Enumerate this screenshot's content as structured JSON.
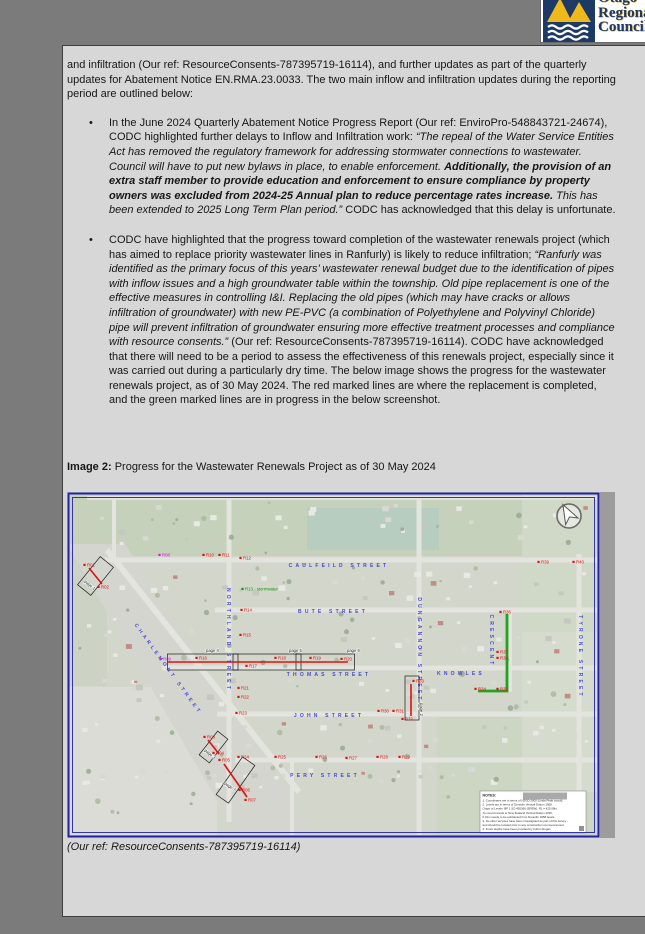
{
  "logo": {
    "line1": "Otago",
    "line2": "Regional",
    "line3": "Council",
    "navy": "#1d3a66",
    "gold": "#efb91c"
  },
  "doc": {
    "bullet_char": "•",
    "para1": [
      {
        "t": "and infiltration (Our ref: ResourceConsents-787395719-16114), and further updates as part of the quarterly updates for Abatement Notice EN.RMA.23.0033. The two main inflow and infiltration updates during the reporting period are outlined below:",
        "s": ""
      }
    ],
    "bullet1": [
      {
        "t": "In the June 2024 Quarterly Abatement Notice Progress Report (Our ref: EnviroPro-548843721-24674), CODC highlighted further delays to Inflow and Infiltration work: ",
        "s": ""
      },
      {
        "t": "“The repeal of the Water Service Entities Act has removed the regulatory framework for addressing stormwater connections to wastewater. Council will have to put new bylaws in place, to enable enforcement. ",
        "s": "i"
      },
      {
        "t": "Additionally, the provision of an extra staff member to provide education and enforcement to ensure compliance by property owners was excluded from 2024-25 Annual plan to reduce percentage rates increase.",
        "s": "bi"
      },
      {
        "t": " This has been extended to 2025 Long Term Plan period.”",
        "s": "i"
      },
      {
        "t": " CODC has acknowledged that this delay is unfortunate.",
        "s": ""
      }
    ],
    "bullet2": [
      {
        "t": "CODC have highlighted that the progress toward completion of the wastewater renewals project (which has aimed to replace priority wastewater lines in Ranfurly) is likely to reduce infiltration; ",
        "s": ""
      },
      {
        "t": "“Ranfurly was identified as the primary focus of this years’ wastewater renewal budget due to the identification of pipes with inflow issues and a high groundwater table within the township. Old pipe replacement is one of the effective measures in controlling I&I. Replacing the old pipes (which may have cracks or allows infiltration of groundwater) with new PE-PVC (a combination of Polyethylene and Polyvinyl Chloride) pipe will prevent infiltration of groundwater ensuring more effective treatment processes and compliance with resource consents.”",
        "s": "i"
      },
      {
        "t": " (Our ref: ResourceConsents-787395719-16114). CODC have acknowledged that there will need to be a period to assess the effectiveness of this renewals project, especially since it was carried out during a particularly dry time. The below image shows the progress for the wastewater renewals project, as of 30 May 2024. The red marked lines are where the replacement is completed, and the green marked lines are in progress in the below screenshot.",
        "s": ""
      }
    ],
    "caption": [
      {
        "t": "Image 2:",
        "s": "b"
      },
      {
        "t": " Progress for the Wastewater Renewals Project as of 30 May 2024",
        "s": ""
      }
    ],
    "footer_ref": [
      {
        "t": "(Our ref: ResourceConsents-787395719-16114)",
        "s": "i"
      }
    ]
  },
  "map": {
    "colors": {
      "red": "#e01010",
      "magenta": "#d818d8",
      "green_line": "#1fa41f",
      "green_text": "#0a9a0a",
      "street_blue": "#3b3bd2",
      "border_blue": "#2323a8"
    },
    "streets": [
      {
        "label": "CAULFEILD STREET",
        "x": 272,
        "y": 75,
        "rot": 0
      },
      {
        "label": "BUTE STREET",
        "x": 266,
        "y": 121,
        "rot": 0
      },
      {
        "label": "THOMAS STREET",
        "x": 262,
        "y": 184,
        "rot": 0
      },
      {
        "label": "JOHN STREET",
        "x": 262,
        "y": 225,
        "rot": 0
      },
      {
        "label": "PERY STREET",
        "x": 258,
        "y": 285,
        "rot": 0
      },
      {
        "label": "KNOWLES",
        "x": 394,
        "y": 183,
        "rot": 0
      },
      {
        "label": "NORTHLAND STREET",
        "x": 160,
        "y": 148,
        "rot": 90
      },
      {
        "label": "DUNGANNON STREET",
        "x": 351,
        "y": 158,
        "rot": 90
      },
      {
        "label": "TYRONE STREET",
        "x": 512,
        "y": 165,
        "rot": 90
      },
      {
        "label": "CRESCENT",
        "x": 423,
        "y": 149,
        "rot": 90
      },
      {
        "label": "CHARLEMONT STREET",
        "x": 100,
        "y": 178,
        "rot": 54
      }
    ],
    "markers": [
      {
        "label": "R01",
        "x": 20,
        "y": 73,
        "c": "r"
      },
      {
        "label": "R02",
        "x": 34,
        "y": 95,
        "c": "r"
      },
      {
        "label": "R03",
        "x": 140,
        "y": 245,
        "c": "r"
      },
      {
        "label": "R04",
        "x": 149,
        "y": 261,
        "c": "r"
      },
      {
        "label": "R05",
        "x": 155,
        "y": 268,
        "c": "r"
      },
      {
        "label": "R06",
        "x": 175,
        "y": 298,
        "c": "r"
      },
      {
        "label": "R07",
        "x": 181,
        "y": 308,
        "c": "r"
      },
      {
        "label": "R08",
        "x": 95,
        "y": 63,
        "c": "m"
      },
      {
        "label": "R09",
        "x": 96,
        "y": 167,
        "c": "m"
      },
      {
        "label": "R10",
        "x": 139,
        "y": 63,
        "c": "r"
      },
      {
        "label": "R11",
        "x": 155,
        "y": 63,
        "c": "r"
      },
      {
        "label": "R12",
        "x": 176,
        "y": 66,
        "c": "r"
      },
      {
        "label": "R13 - stormwater",
        "x": 178,
        "y": 97,
        "c": "g"
      },
      {
        "label": "R14",
        "x": 177,
        "y": 118,
        "c": "r"
      },
      {
        "label": "R15",
        "x": 176,
        "y": 143,
        "c": "r"
      },
      {
        "label": "R16",
        "x": 132,
        "y": 166,
        "c": "r"
      },
      {
        "label": "R17",
        "x": 182,
        "y": 174,
        "c": "r"
      },
      {
        "label": "R18",
        "x": 211,
        "y": 166,
        "c": "r"
      },
      {
        "label": "R19",
        "x": 246,
        "y": 166,
        "c": "r"
      },
      {
        "label": "R20",
        "x": 277,
        "y": 167,
        "c": "r"
      },
      {
        "label": "R21",
        "x": 174,
        "y": 196,
        "c": "r"
      },
      {
        "label": "R22",
        "x": 174,
        "y": 205,
        "c": "r"
      },
      {
        "label": "R23",
        "x": 172,
        "y": 221,
        "c": "r"
      },
      {
        "label": "R24",
        "x": 174,
        "y": 265,
        "c": "r"
      },
      {
        "label": "R25",
        "x": 211,
        "y": 265,
        "c": "r"
      },
      {
        "label": "R26",
        "x": 252,
        "y": 265,
        "c": "r"
      },
      {
        "label": "R27",
        "x": 282,
        "y": 266,
        "c": "r"
      },
      {
        "label": "R28",
        "x": 313,
        "y": 265,
        "c": "r"
      },
      {
        "label": "R29",
        "x": 335,
        "y": 265,
        "c": "r"
      },
      {
        "label": "R30",
        "x": 314,
        "y": 219,
        "c": "r"
      },
      {
        "label": "R31",
        "x": 329,
        "y": 219,
        "c": "r"
      },
      {
        "label": "R32",
        "x": 338,
        "y": 227,
        "c": "r"
      },
      {
        "label": "R33",
        "x": 349,
        "y": 189,
        "c": "r"
      },
      {
        "label": "R34",
        "x": 411,
        "y": 197,
        "c": "r"
      },
      {
        "label": "R35",
        "x": 433,
        "y": 197,
        "c": "r"
      },
      {
        "label": "R36",
        "x": 436,
        "y": 120,
        "c": "r"
      },
      {
        "label": "R37",
        "x": 433,
        "y": 160,
        "c": "r"
      },
      {
        "label": "R38",
        "x": 433,
        "y": 166,
        "c": "r"
      },
      {
        "label": "R39",
        "x": 474,
        "y": 70,
        "c": "r"
      },
      {
        "label": "R40",
        "x": 509,
        "y": 70,
        "c": "r"
      }
    ],
    "lines": [
      {
        "c": "#e01010",
        "w": 1.6,
        "pts": [
          [
            22,
            76
          ],
          [
            35,
            92
          ]
        ]
      },
      {
        "c": "#e01010",
        "w": 1.6,
        "pts": [
          [
            100,
            170
          ],
          [
            281,
            170
          ]
        ]
      },
      {
        "c": "#e01010",
        "w": 1.6,
        "pts": [
          [
            344,
            192
          ],
          [
            344,
            224
          ]
        ]
      },
      {
        "c": "#e01010",
        "w": 1.6,
        "pts": [
          [
            141,
            248
          ],
          [
            152,
            262
          ]
        ]
      },
      {
        "c": "#e01010",
        "w": 1.6,
        "pts": [
          [
            157,
            272
          ],
          [
            180,
            305
          ]
        ]
      },
      {
        "c": "#1fa41f",
        "w": 2.8,
        "pts": [
          [
            440,
            122
          ],
          [
            440,
            199
          ],
          [
            411,
            199
          ]
        ]
      }
    ],
    "boxes": [
      {
        "cx": 28.5,
        "cy": 84,
        "w": 17,
        "h": 36,
        "rot": 39
      },
      {
        "cx": 194,
        "cy": 170,
        "w": 187,
        "h": 16,
        "rot": 0
      },
      {
        "cx": 168.5,
        "cy": 170,
        "w": 5,
        "h": 16,
        "rot": 0
      },
      {
        "cx": 231.5,
        "cy": 170,
        "w": 5,
        "h": 16,
        "rot": 0
      },
      {
        "cx": 345,
        "cy": 206,
        "w": 14,
        "h": 44,
        "rot": 0
      },
      {
        "cx": 146.5,
        "cy": 255,
        "w": 13,
        "h": 30,
        "rot": 38
      },
      {
        "cx": 168.5,
        "cy": 288,
        "w": 15,
        "h": 46,
        "rot": 35
      }
    ],
    "page_labels": [
      {
        "label": "page 4",
        "x": 139,
        "y": 160,
        "rot": 0
      },
      {
        "label": "page 5",
        "x": 222,
        "y": 160,
        "rot": 0
      },
      {
        "label": "page 6",
        "x": 280,
        "y": 160,
        "rot": 0
      },
      {
        "label": "page 2",
        "x": 353,
        "y": 211,
        "rot": 90
      },
      {
        "label": "page 1",
        "x": 17,
        "y": 90,
        "rot": 39
      },
      {
        "label": "page 3",
        "x": 137,
        "y": 259,
        "rot": 38
      },
      {
        "label": "page 7",
        "x": 157,
        "y": 292,
        "rot": 35
      }
    ],
    "notes": {
      "title": "NOTES:",
      "lines": [
        "1. Coordinates are in terms of NZGD 2000 (Linda Peak circuit).",
        "2. Levels are in terms of Dunedin Vertical Datum 1958.",
        "    Origin of Levels: BP 1 SO 495366 (EREW), RL = 425.08m.",
        "    To convert levels to New Zealand Vertical Datum 2016,",
        "    0.31m needs to be subtracted from Dunedin 1958 levels.",
        "3. No other services have been investigated as part of this survey -",
        "    and should be located prior to any construction commencement.",
        "4. Invert depths have been provided by Fulton Hogan."
      ]
    }
  }
}
